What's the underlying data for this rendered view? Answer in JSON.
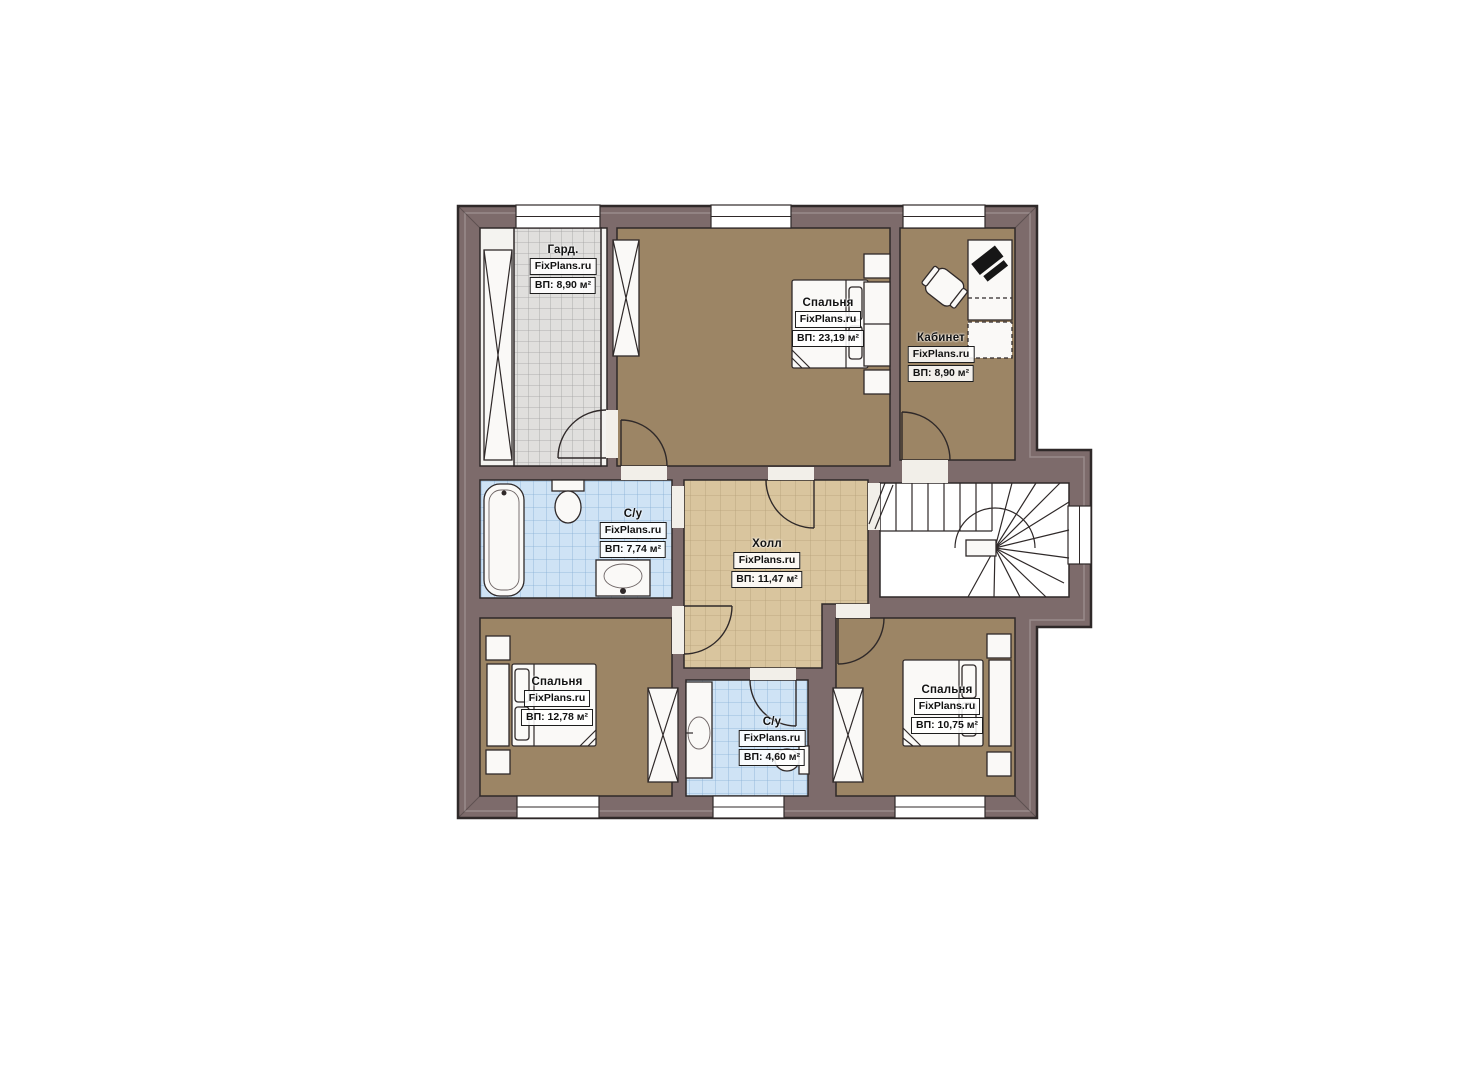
{
  "plan": {
    "brand": "FixPlans.ru",
    "colors": {
      "wall": "#7d6b6b",
      "outline": "#2f2929",
      "bedroomFloor": "#9c8565",
      "hallFloor": "#d9c59e",
      "bathFloor": "#cfe3f5",
      "wardrobeFloor": "#e0dfdd",
      "wardrobeBase": "#f4f3f0",
      "stairFloor": "#ffffff"
    },
    "rooms": [
      {
        "id": "wardrobe",
        "name": "Гард.",
        "brand": "FixPlans.ru",
        "area": "ВП: 8,90 м²"
      },
      {
        "id": "bedroom-top",
        "name": "Спальня",
        "brand": "FixPlans.ru",
        "area": "ВП: 23,19 м²"
      },
      {
        "id": "office",
        "name": "Кабинет",
        "brand": "FixPlans.ru",
        "area": "ВП: 8,90 м²"
      },
      {
        "id": "bathroom-main",
        "name": "С/у",
        "brand": "FixPlans.ru",
        "area": "ВП: 7,74 м²"
      },
      {
        "id": "hall",
        "name": "Холл",
        "brand": "FixPlans.ru",
        "area": "ВП: 11,47 м²"
      },
      {
        "id": "bedroom-left",
        "name": "Спальня",
        "brand": "FixPlans.ru",
        "area": "ВП: 12,78 м²"
      },
      {
        "id": "bathroom-small",
        "name": "С/у",
        "brand": "FixPlans.ru",
        "area": "ВП: 4,60 м²"
      },
      {
        "id": "bedroom-right",
        "name": "Спальня",
        "brand": "FixPlans.ru",
        "area": "ВП: 10,75 м²"
      }
    ]
  }
}
